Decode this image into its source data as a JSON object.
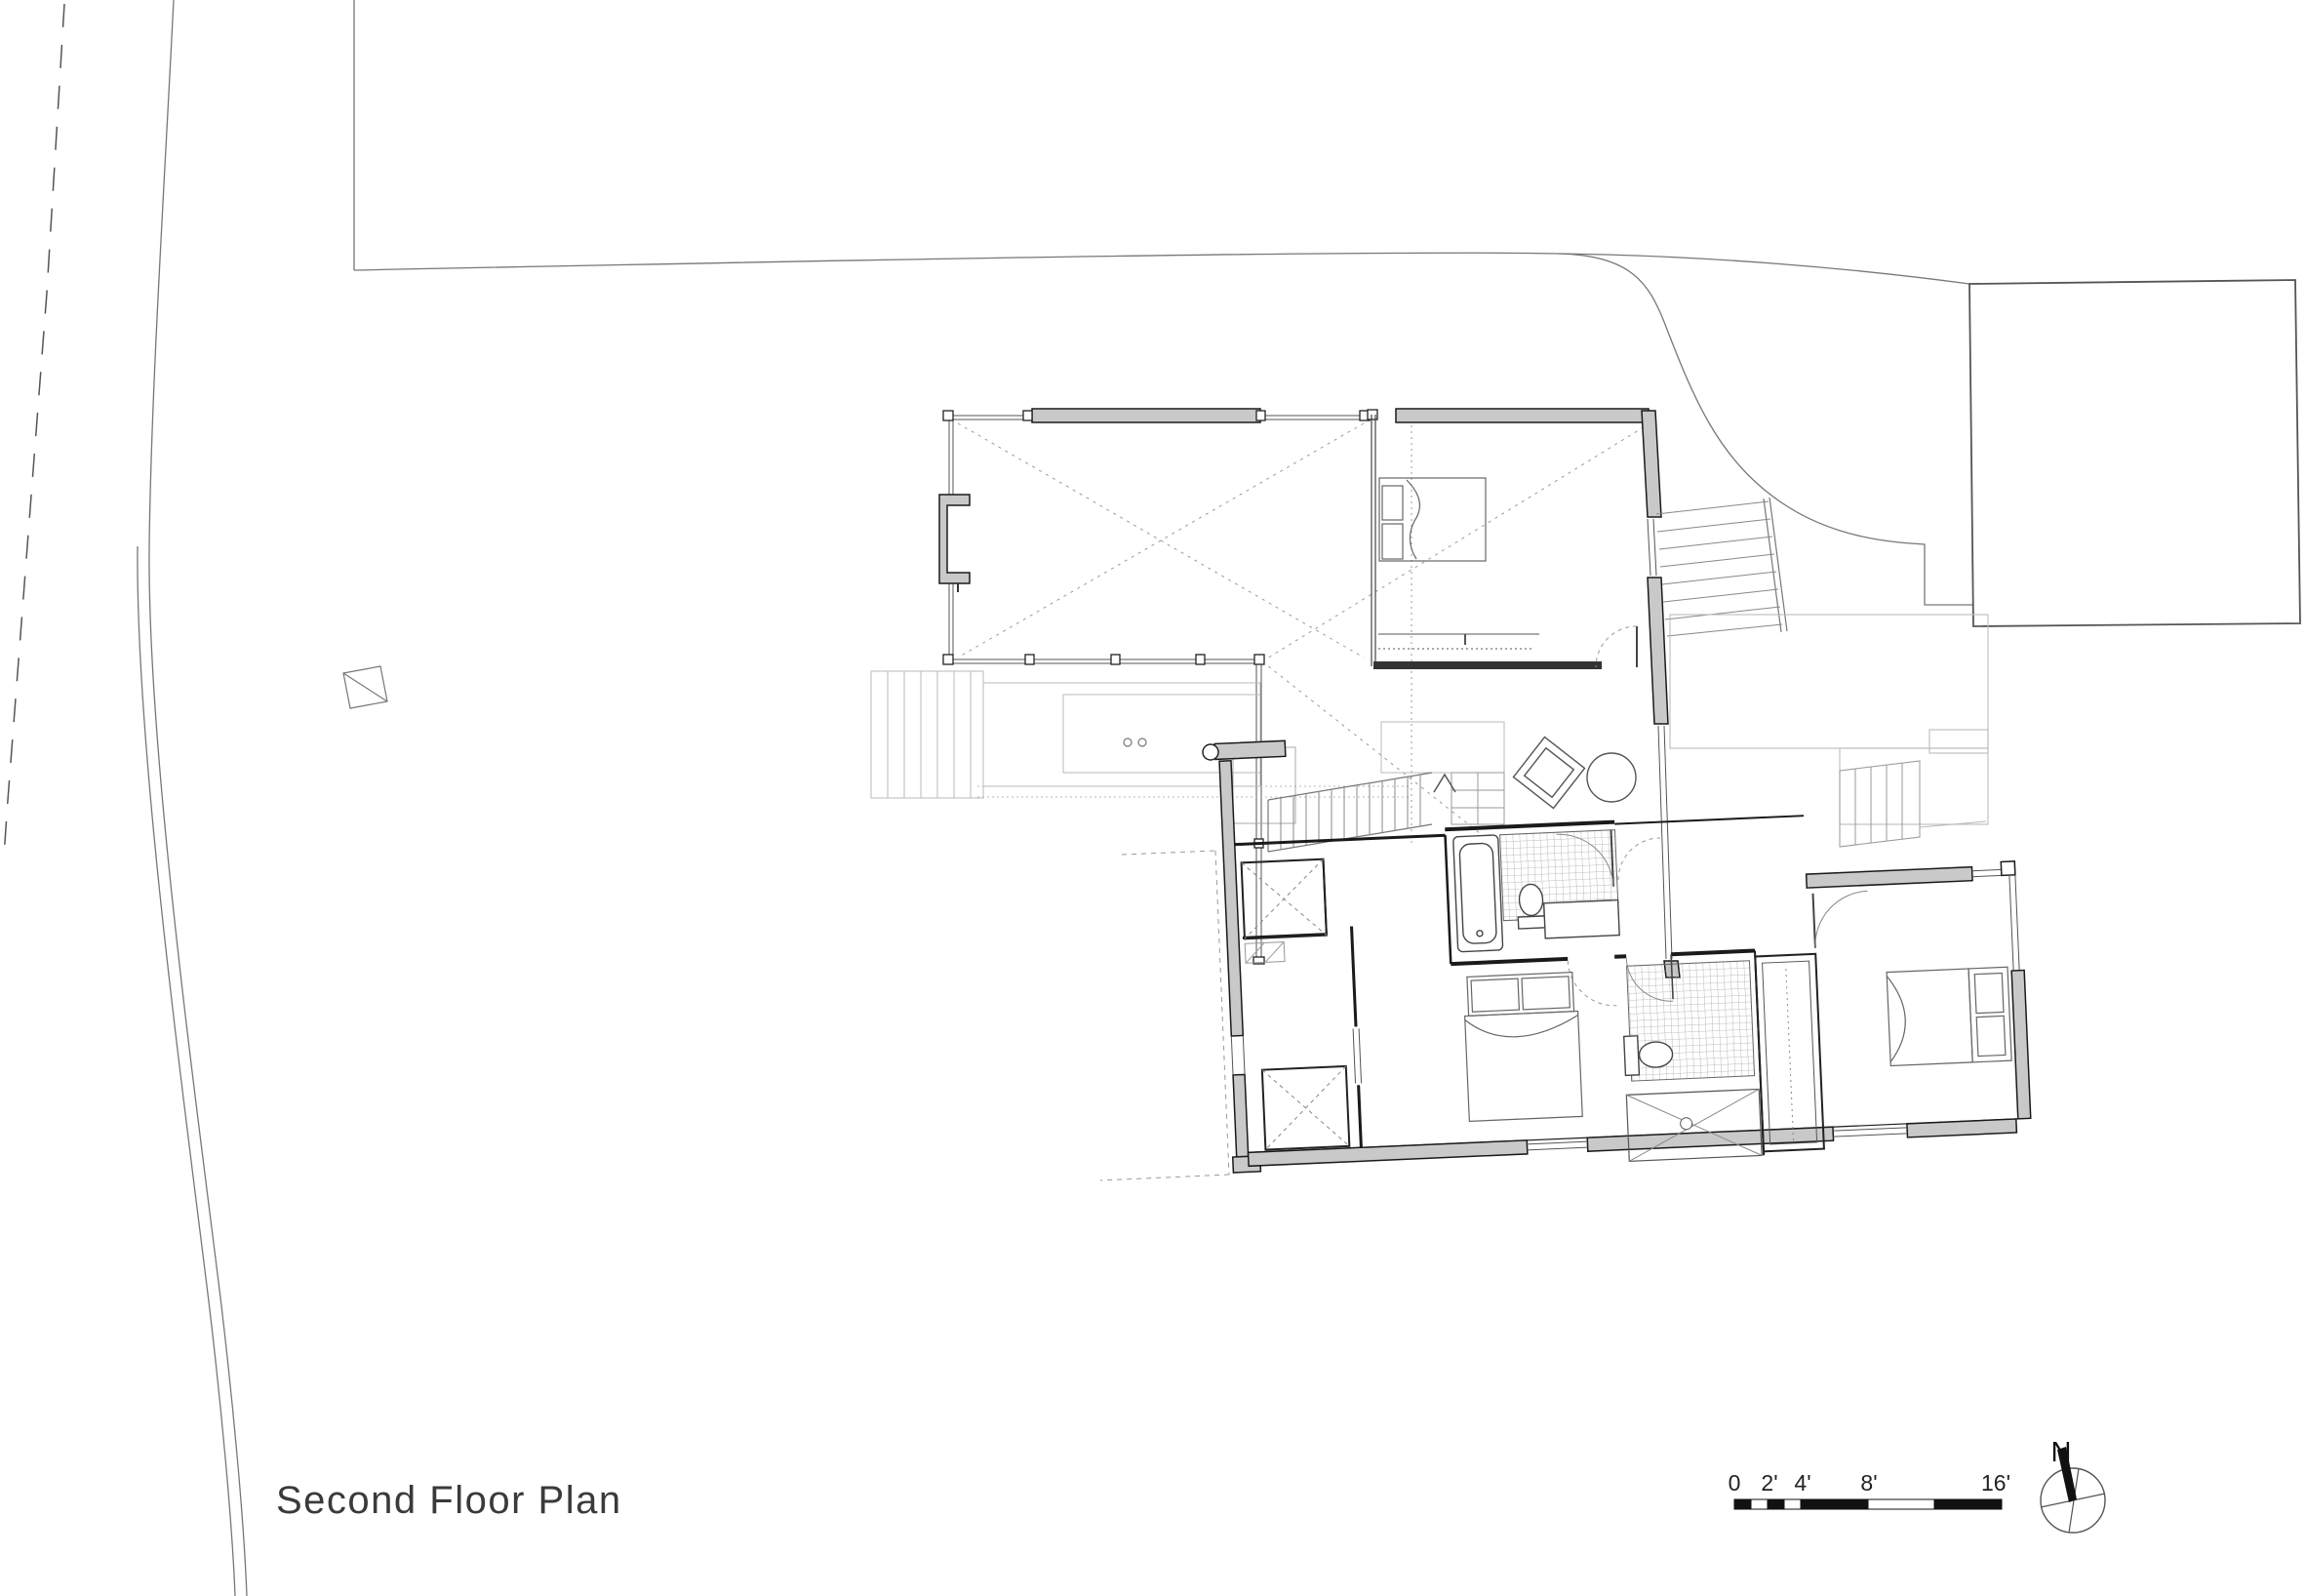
{
  "drawing": {
    "title": "Second Floor Plan"
  },
  "scale_bar": {
    "ticks": [
      "0",
      "2'",
      "4'",
      "8'",
      "16'"
    ]
  },
  "compass": {
    "north_label": "N"
  },
  "palette": {
    "paper": "#ffffff",
    "wall_fill": "#c9c9c9",
    "wall_stroke": "#1a1a1a",
    "line_mid": "#777777",
    "line_light": "#b9b9b9",
    "dash": "#999999",
    "text": "#3a3a3a"
  }
}
